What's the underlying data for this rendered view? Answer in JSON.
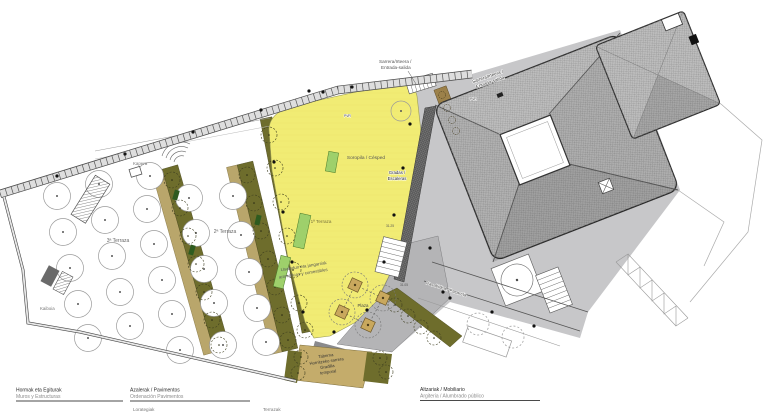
{
  "plan_labels": {
    "entrance_line1": "Sarrera/Irteera /",
    "entrance_line2": "Entrada-salida",
    "kapera": "Kapera",
    "terrace3": "3ª Terraza",
    "terrace2": "2ª Terraza",
    "terrace1": "1ª Terraza",
    "lawn": "Soropila / Césped",
    "steps_line1": "Gradas /",
    "steps_line2": "Escaleras",
    "aromatic_line1": "Usaindun eta jangarriak",
    "aromatic_line2": "aromáticas y comestibles",
    "plaza": "Plaza",
    "kaiboia": "Kaiboia",
    "tavern_line1": "Taberna",
    "tavern_line2": "Hornitzeko sarrera",
    "tavern_line3": "Gradilla",
    "tavern_line4": "temporal",
    "walkway": "Pasabidea / Pasarela",
    "pvr": "PVR",
    "level_a": "31.25",
    "level_b": "31.05"
  },
  "legend": {
    "structures_eu": "Hormak eta Egiturak",
    "structures_es": "Muros y Estructuras",
    "pavements_eu": "Azalerak / Pavimentos",
    "pavements_es": "Ordenación Pavimentos",
    "pavements_item1": "Lorategiak",
    "pavements_item2": "Terrazak",
    "furniture_eu": "Altzariak / Mobiliario",
    "lighting_es": "Argiteria / Alumbrado público"
  },
  "colors": {
    "lawn": "#F1EC74",
    "olive": "#6E6D2C",
    "light_green": "#9ED06B",
    "path_tan": "#B9A66B",
    "tavern_tan": "#C4AC6B",
    "planter_tan": "#C9A85D",
    "plaza_gray": "#B4B4B6",
    "roof_gray": "#BDBDBD"
  }
}
